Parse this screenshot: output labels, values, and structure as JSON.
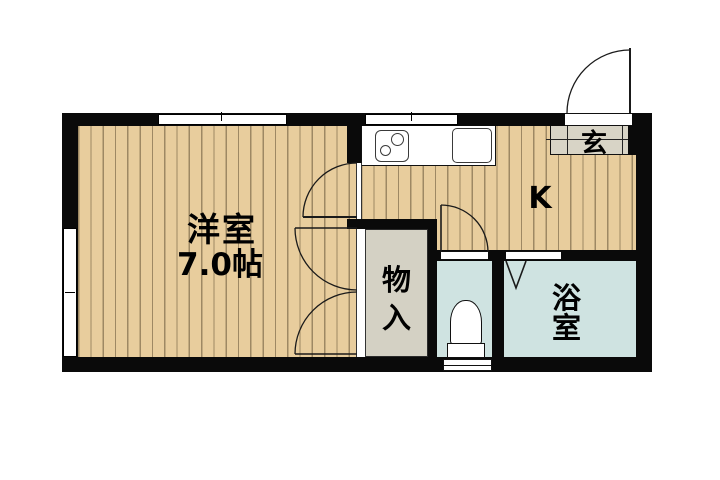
{
  "floorplan": {
    "type": "japanese-apartment-floorplan",
    "rooms": {
      "western_room": {
        "label": "洋室",
        "size": "7.0帖"
      },
      "kitchen": {
        "label": "K"
      },
      "closet": {
        "label": "物入"
      },
      "bathroom": {
        "label": "浴室"
      },
      "entrance": {
        "label": "玄"
      }
    },
    "fixtures": [
      "kitchen-counter",
      "stove-burners",
      "sink",
      "toilet",
      "entrance-swing-door",
      "kitchen-swing-door",
      "closet-double-doors",
      "toilet-swing-door",
      "bath-folding-door",
      "windows"
    ],
    "colors": {
      "wall": "#0a0a0a",
      "wood_floor": "#e8cd9d",
      "wood_stripe": "#60503480",
      "wet_area_floor": "#cfe3e1",
      "closet_floor": "#d4d1c4",
      "entrance_tile": "#d8d4c6",
      "background": "#ffffff"
    }
  }
}
